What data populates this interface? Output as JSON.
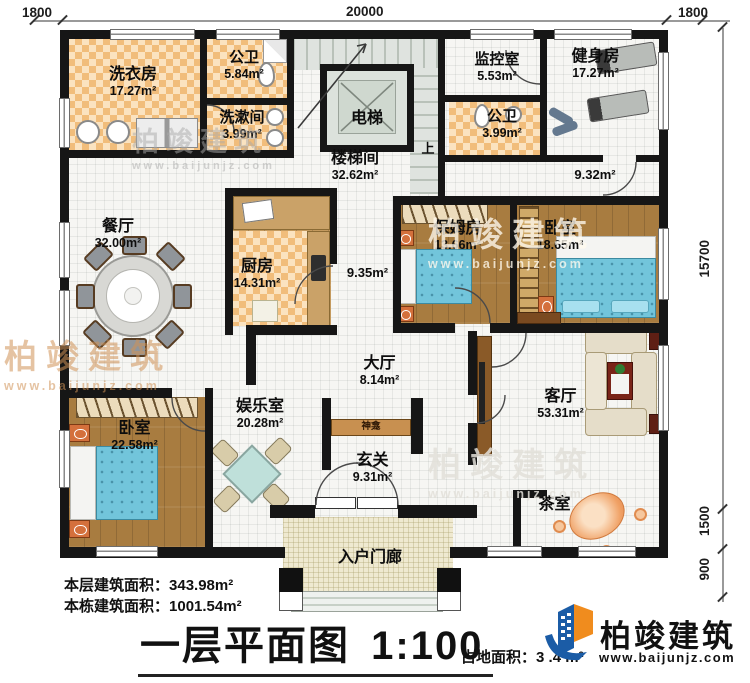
{
  "dimensions": {
    "top_left": "1800",
    "top": "20000",
    "top_right": "1800",
    "right_main": "15700",
    "right_mid": "1500",
    "right_bottom": "900"
  },
  "rooms": {
    "laundry": {
      "name": "洗衣房",
      "area": "17.27m²"
    },
    "bath1": {
      "name": "公卫",
      "area": "5.84m²"
    },
    "washroom": {
      "name": "洗漱间",
      "area": "3.99m²"
    },
    "elevator": {
      "name": "电梯"
    },
    "stairwell": {
      "name": "楼梯间",
      "area": "32.62m²"
    },
    "stairs_up": "上",
    "monitor": {
      "name": "监控室",
      "area": "5.53m²"
    },
    "bath2": {
      "name": "公卫",
      "area": "3.99m²"
    },
    "gym": {
      "name": "健身房",
      "area": "17.27m²"
    },
    "corridor_right": {
      "area": "9.32m²"
    },
    "dining": {
      "name": "餐厅",
      "area": "32.00m²"
    },
    "kitchen": {
      "name": "厨房",
      "area": "14.31m²"
    },
    "corridor_mid": {
      "area": "9.35m²"
    },
    "nanny": {
      "name": "保姆房",
      "area": "13.66m²"
    },
    "bedroom1": {
      "name": "卧室",
      "area": "18.65m²"
    },
    "hall": {
      "name": "大厅",
      "area": "8.14m²"
    },
    "game": {
      "name": "娱乐室",
      "area": "20.28m²"
    },
    "shrine": {
      "name": "神龛"
    },
    "foyer": {
      "name": "玄关",
      "area": "9.31m²"
    },
    "living": {
      "name": "客厅",
      "area": "53.31m²"
    },
    "tea": {
      "name": "茶室"
    },
    "bedroom2": {
      "name": "卧室",
      "area": "22.58m²"
    },
    "porch": {
      "name": "入户门廊"
    }
  },
  "footer": {
    "floor_area_label": "本层建筑面积：",
    "floor_area_value": "343.98m²",
    "building_area_label": "本栋建筑面积：",
    "building_area_value": "1001.54m²",
    "title": "一层平面图",
    "scale": "1:100",
    "land_area_label": "占地面积：",
    "land_area_value": "3  .4  m²"
  },
  "brand": {
    "name": "柏竣建筑",
    "url": "www.baijunjz.com"
  },
  "watermark": {
    "text": "柏竣建筑",
    "url": "www.baijunjz.com"
  },
  "colors": {
    "wall": "#161616",
    "checker": "#f1bd7b",
    "wood": "#a87c40",
    "bed": "#72c5db",
    "brand_blue": "#1b5ca6",
    "brand_orange": "#f08c1e"
  }
}
